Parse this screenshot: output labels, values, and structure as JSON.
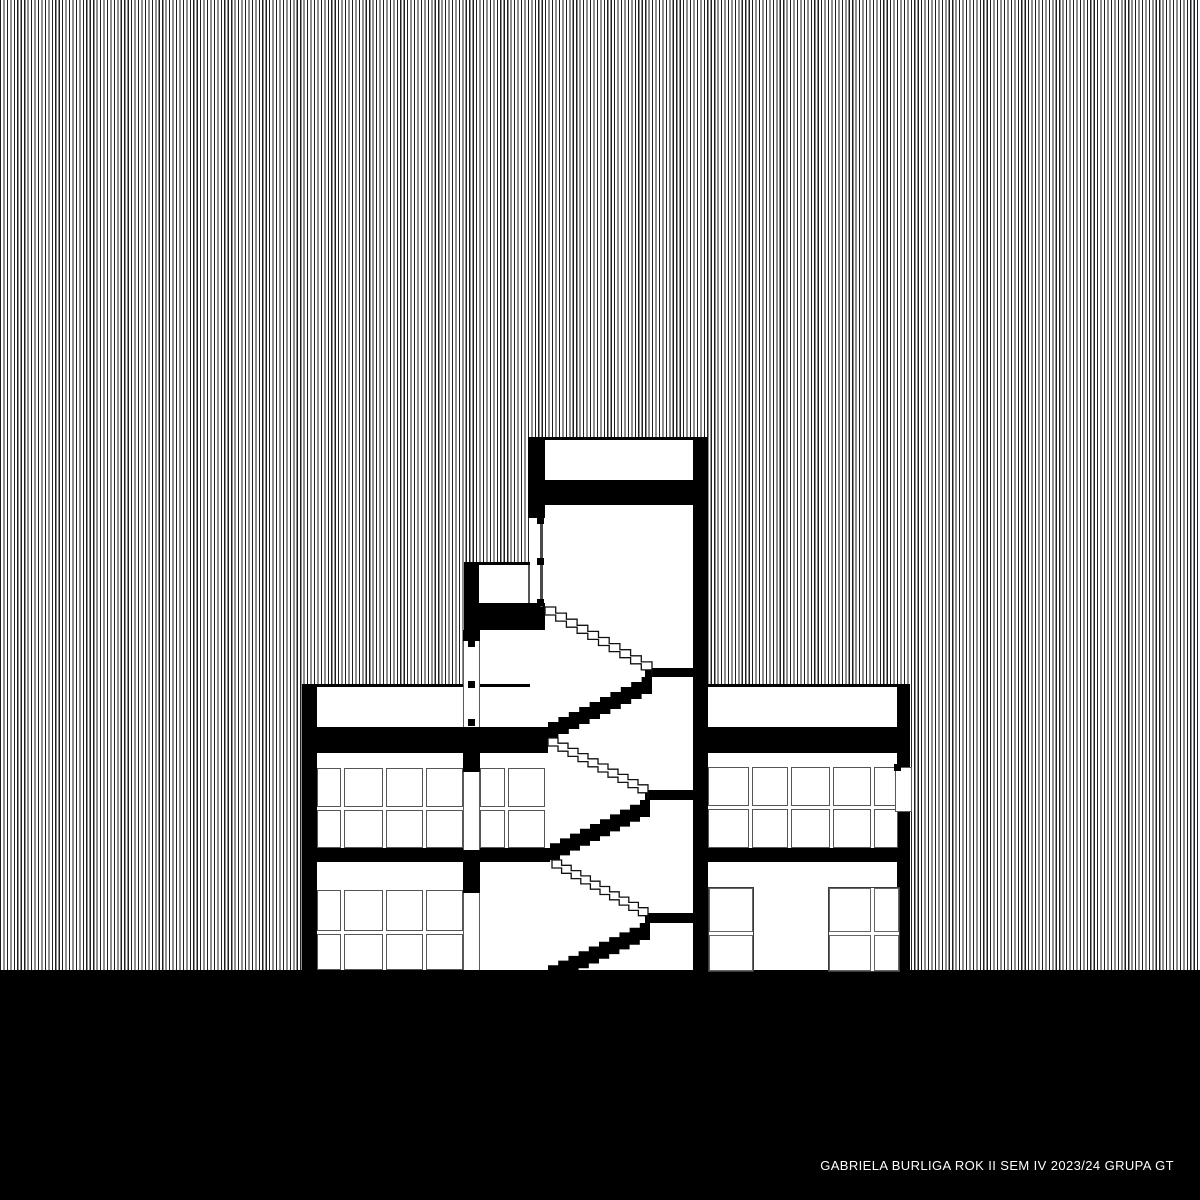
{
  "figure": {
    "type": "architectural cross-section drawing, black and white",
    "caption": "GABRIELA BURLIGA ROK II SEM IV 2023/24 GRUPA GT"
  },
  "palette": {
    "ink": "#000000",
    "paper": "#ffffff",
    "stripe_line": "#1f1f1f",
    "frame_line": "#555555"
  }
}
